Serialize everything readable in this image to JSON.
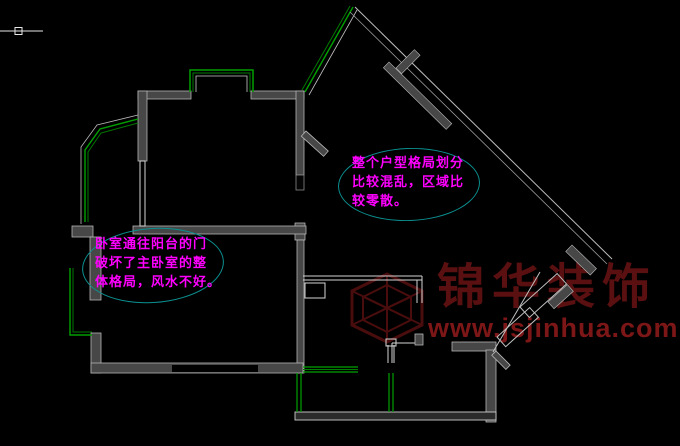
{
  "canvas": {
    "background": "#000000"
  },
  "annotations": {
    "bedroom_note": {
      "lines": [
        "卧室通往阳台的门",
        "破坏了主卧室的整",
        "体格局，风水不好。"
      ],
      "text_color": "#ff00ff",
      "ellipse_color": "#0c9090"
    },
    "layout_note": {
      "lines": [
        "整个户型格局划分",
        "比较混乱，区域比",
        "较零散。"
      ],
      "text_color": "#ff00ff",
      "ellipse_color": "#0c9090"
    }
  },
  "watermark": {
    "company": "锦华装饰",
    "website": "www.jsjinhua.com",
    "company_color": "#5a1010",
    "website_color": "#7d1616",
    "logo_color": "#4a0d0d"
  },
  "plan": {
    "wall_fill": "#474747",
    "wall_edge": "#b5b5b5",
    "window_color": "#00a000",
    "partition_color": "#d5d5d5",
    "cursor_color": "#e8e8e8"
  }
}
